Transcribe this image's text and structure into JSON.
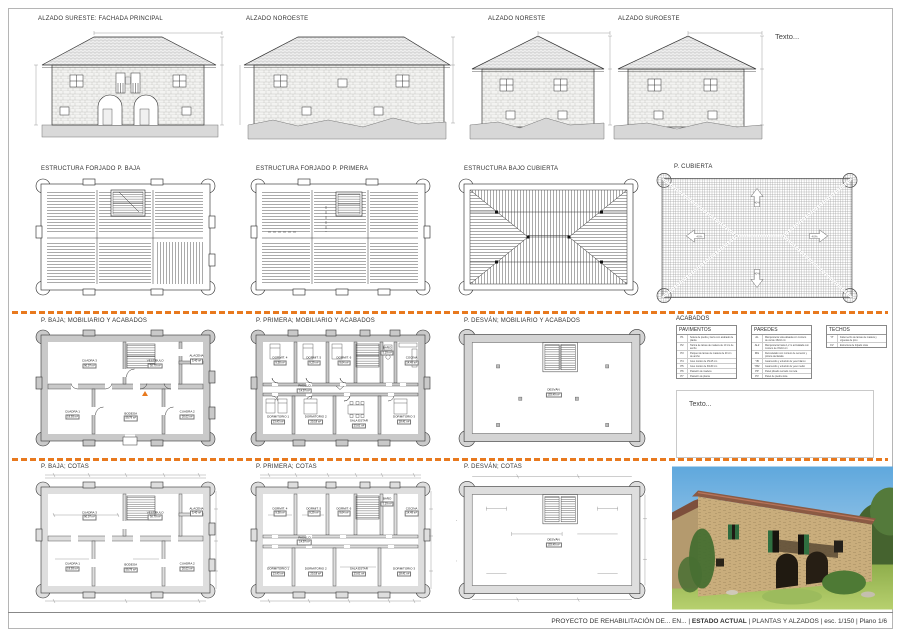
{
  "sheet": {
    "accent_orange": "#E8791E",
    "notes_top": "Texto...",
    "notes_box": "Texto...",
    "title_block": {
      "project": "PROYECTO DE REHABILITACIÓN DE... EN...",
      "sep": " | ",
      "phase": "ESTADO ACTUAL",
      "content": "PLANTAS Y ALZADOS",
      "scale": "esc. 1/150",
      "sheet_no": "Plano 1/6"
    }
  },
  "elevations": [
    {
      "label": "ALZADO SURESTE: FACHADA PRINCIPAL"
    },
    {
      "label": "ALZADO NOROESTE"
    },
    {
      "label": "ALZADO NORESTE"
    },
    {
      "label": "ALZADO SUROESTE"
    }
  ],
  "structure": [
    {
      "label": "ESTRUCTURA FORJADO P. BAJA"
    },
    {
      "label": "ESTRUCTURA FORJADO P. PRIMERA"
    },
    {
      "label": "ESTRUCTURA BAJO CUBIERTA"
    },
    {
      "label": "P. CUBIERTA",
      "slope": "40%"
    }
  ],
  "plans": {
    "baja_mob": {
      "label": "P. BAJA; MOBILIARIO Y ACABADOS"
    },
    "primera_mob": {
      "label": "P. PRIMERA; MOBILIARIO Y ACABADOS"
    },
    "desvan_mob": {
      "label": "P. DESVÁN; MOBILIARIO Y ACABADOS"
    },
    "baja_cotas": {
      "label": "P. BAJA; COTAS"
    },
    "primera_cotas": {
      "label": "P. PRIMERA; COTAS"
    },
    "desvan_cotas": {
      "label": "P. DESVÁN; COTAS"
    },
    "rooms_baja": [
      {
        "name": "CUADRA 3",
        "area": "90,07 m²"
      },
      {
        "name": "VESTÍBULO",
        "area": "30,79 m²"
      },
      {
        "name": "ALACENA",
        "area": "5,40 m²"
      },
      {
        "name": "CUADRA 1",
        "area": "19,93 m²"
      },
      {
        "name": "BODEGA",
        "area": "59,79 m²"
      },
      {
        "name": "CUADRA 2",
        "area": "20,02 m²"
      }
    ],
    "rooms_primera": [
      {
        "name": "DORMIT. 4",
        "area": "9,38 m²"
      },
      {
        "name": "DORMIT. 5",
        "area": "9,29 m²"
      },
      {
        "name": "DORMIT. 6",
        "area": "9,64 m²"
      },
      {
        "name": "BAÑO",
        "area": "5,19 m²"
      },
      {
        "name": "COCINA",
        "area": "14,49 m²"
      },
      {
        "name": "PASILLO",
        "area": "14,97 m²"
      },
      {
        "name": "DORMITORIO 1",
        "area": "13,43 m²"
      },
      {
        "name": "DORMITORIO 2",
        "area": "20,18 m²"
      },
      {
        "name": "SALA ESTAR",
        "area": "23,61 m²"
      },
      {
        "name": "DORMITORIO 3",
        "area": "18,41 m²"
      }
    ],
    "rooms_desvan": [
      {
        "name": "DESVÁN",
        "area": "153,49 m²"
      }
    ]
  },
  "acabados": {
    "title": "ACABADOS",
    "tables": [
      {
        "title": "PAVIMENTOS",
        "rows": [
          {
            "code": "P1",
            "desc": "Solera de piedra y tierra con acabado de planta"
          },
          {
            "code": "P2",
            "desc": "Tarima de lamas de madera de 10 cm de ancho"
          },
          {
            "code": "P3",
            "desc": "Parquet de lamas de madera de 20 cm de ancho"
          },
          {
            "code": "P4",
            "desc": "Gres rústico de 15x15 cm"
          },
          {
            "code": "P5",
            "desc": "Gres rústico de 30x30 cm"
          },
          {
            "code": "P6",
            "desc": "Pastelón de madera"
          },
          {
            "code": "P7",
            "desc": "Pastelón de planta"
          }
        ]
      },
      {
        "title": "PAREDES",
        "rows": [
          {
            "code": "AL",
            "desc": "Mampostería vista alisada con mortero de cal de 15x10 cm"
          },
          {
            "code": "AL2",
            "desc": "Mampostería hasta 1,2 m acristalada con mortero de 15x10 cm"
          },
          {
            "code": "MG",
            "desc": "Remodelado con mortero de cemento y pintura declarada"
          },
          {
            "code": "YB",
            "desc": "Guarnecido y enlucido de yeso blanco"
          },
          {
            "code": "YB2",
            "desc": "Guarnecido y enlucido de yeso medio"
          },
          {
            "code": "PP",
            "desc": "Panel plisado cerrado con tela"
          },
          {
            "code": "PV",
            "desc": "Panel de piedra vista"
          }
        ]
      },
      {
        "title": "TECHOS",
        "rows": [
          {
            "code": "YT",
            "desc": "Falso techo de lamas de madera y viguetas de pino"
          },
          {
            "code": "FV",
            "desc": "Estructura de forjado vista"
          }
        ]
      }
    ]
  }
}
